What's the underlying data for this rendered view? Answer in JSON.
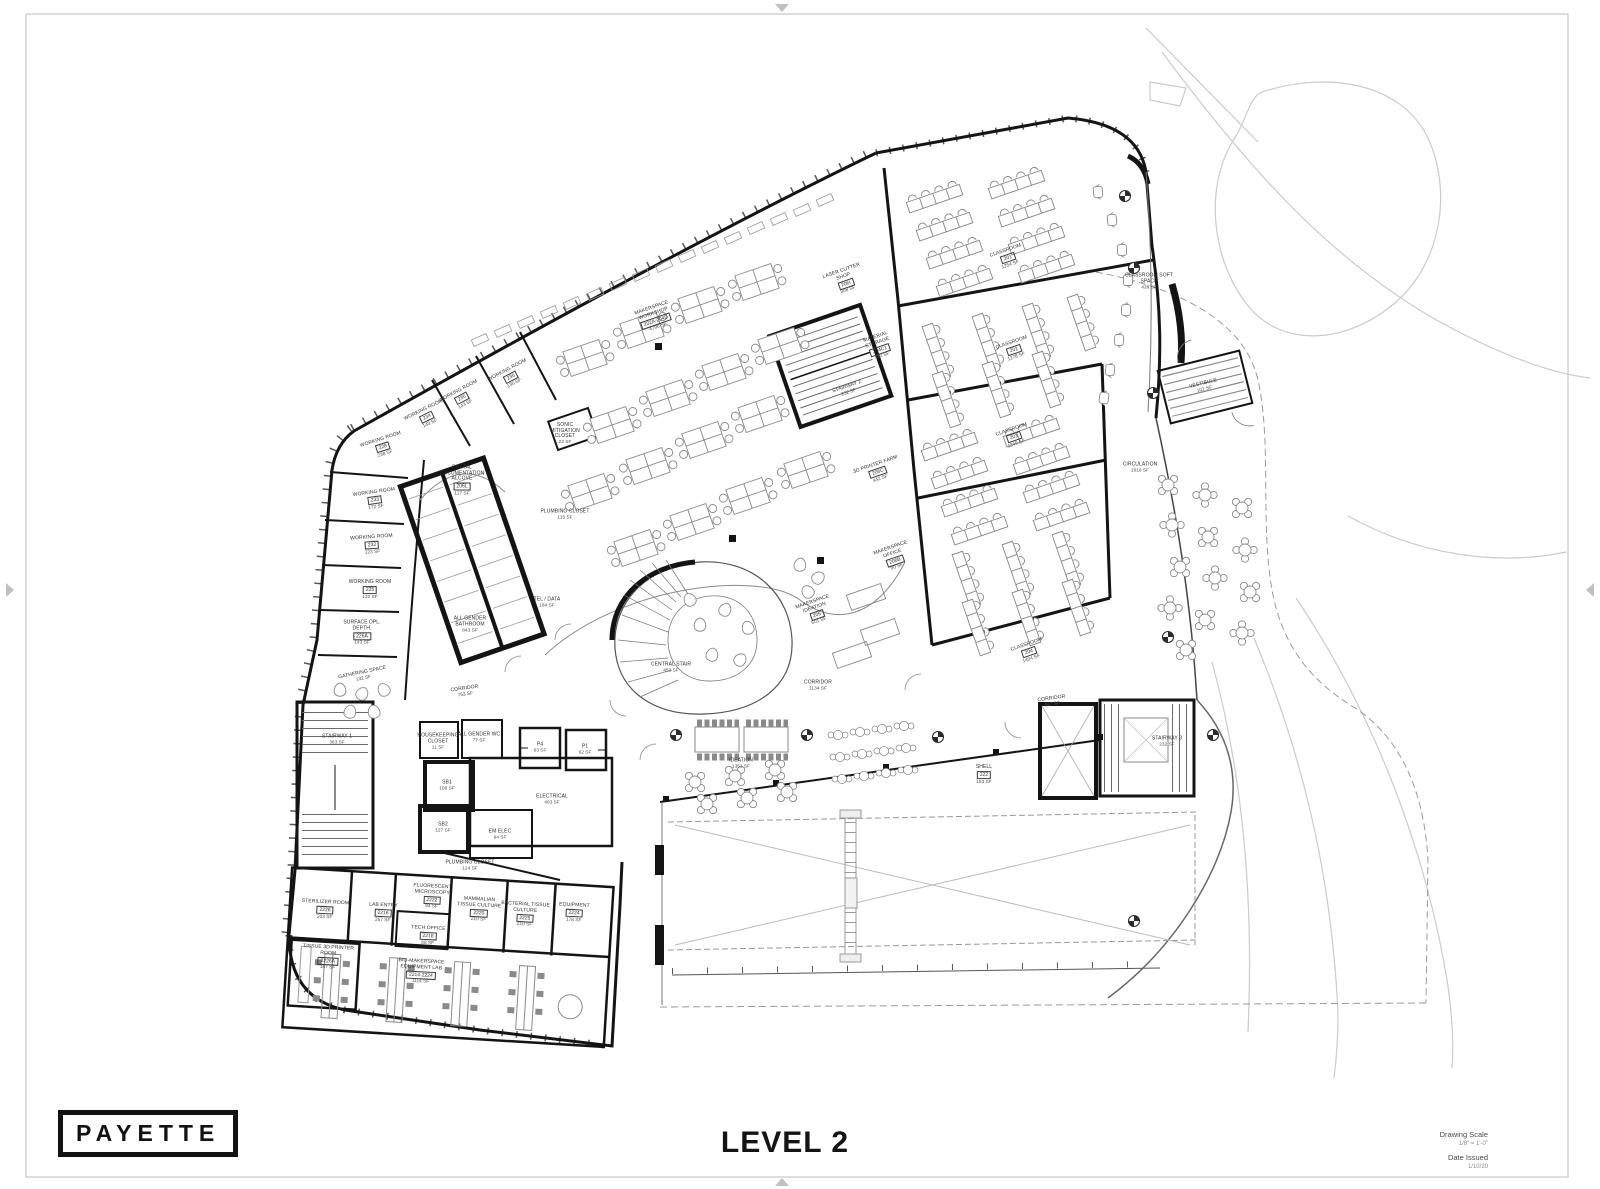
{
  "sheet": {
    "logo": "PAYETTE",
    "title": "LEVEL 2",
    "title_block": {
      "scale_label": "Drawing Scale",
      "scale_value": "1/8\" = 1'-0\"",
      "date_label": "Date Issued",
      "date_value": "1/10/20"
    },
    "line_color": "#141414",
    "site_line_color": "#cbcbcb"
  },
  "plan": {
    "rooms": [
      {
        "name": "MAKERSPACE\nWORKSHOP",
        "num": "202A-204D",
        "sf": "4796 SF",
        "x": 655,
        "y": 318,
        "rot": -19
      },
      {
        "name": "LASER CUTTER\nSHOP",
        "num": "206I",
        "sf": "308 SF",
        "x": 845,
        "y": 281,
        "rot": -19
      },
      {
        "name": "MATERIAL\nSTORAGE",
        "num": "204C1",
        "sf": "432 SF",
        "x": 879,
        "y": 347,
        "rot": -19
      },
      {
        "name": "STAIRWAY 2",
        "num": "",
        "sf": "232 SF",
        "x": 848,
        "y": 390,
        "rot": -19
      },
      {
        "name": "CLASSROOM",
        "num": "201",
        "sf": "1254 SF",
        "x": 1008,
        "y": 258,
        "rot": -19
      },
      {
        "name": "CLASSROOM SOFT\nSPACE",
        "num": "",
        "sf": "438 SF",
        "x": 1149,
        "y": 282,
        "rot": 0
      },
      {
        "name": "CLASSROOM",
        "num": "202",
        "sf": "1278 SF",
        "x": 1014,
        "y": 350,
        "rot": -19
      },
      {
        "name": "CLASSROOM",
        "num": "203",
        "sf": "1349 SF",
        "x": 1014,
        "y": 437,
        "rot": -19
      },
      {
        "name": "CLASSROOM",
        "num": "204",
        "sf": "1404 SF",
        "x": 1029,
        "y": 652,
        "rot": -19
      },
      {
        "name": "CIRCULATION",
        "num": "",
        "sf": "1616 SF",
        "x": 1140,
        "y": 468,
        "rot": 0
      },
      {
        "name": "3D PRINTER FARM",
        "num": "206C",
        "sf": "442 SF",
        "x": 878,
        "y": 472,
        "rot": -19
      },
      {
        "name": "MAKERSPACE\nOFFICE",
        "num": "206B",
        "sf": "90 SF",
        "x": 894,
        "y": 558,
        "rot": -19
      },
      {
        "name": "MAKERSPACE\nIDEATION",
        "num": "205",
        "sf": "501 SF",
        "x": 816,
        "y": 612,
        "rot": -19
      },
      {
        "name": "CORRIDOR",
        "num": "",
        "sf": "1134 SF",
        "x": 818,
        "y": 686,
        "rot": 0
      },
      {
        "name": "CENTRAL STAIR",
        "num": "",
        "sf": "452 SF",
        "x": 671,
        "y": 668,
        "rot": 0
      },
      {
        "name": "SONIC\nMITIGATION\nCLOSET",
        "num": "",
        "sf": "23 SF",
        "x": 565,
        "y": 434,
        "rot": 0
      },
      {
        "name": "DIGITAL\nDOCUMENTATION\nALCOVE",
        "num": "206L",
        "sf": "117 SF",
        "x": 462,
        "y": 481,
        "rot": 0
      },
      {
        "name": "PLUMBING CLOSET",
        "num": "",
        "sf": "115 SF",
        "x": 565,
        "y": 515,
        "rot": 0
      },
      {
        "name": "TEL / DATA",
        "num": "",
        "sf": "184 SF",
        "x": 547,
        "y": 603,
        "rot": 0
      },
      {
        "name": "ALL GENDER\nBATHROOM",
        "num": "",
        "sf": "843 SF",
        "x": 470,
        "y": 625,
        "rot": 0
      },
      {
        "name": "WORKING ROOM",
        "num": "236",
        "sf": "135 SF",
        "x": 511,
        "y": 377,
        "rot": -28
      },
      {
        "name": "WORKING ROOM",
        "num": "235",
        "sf": "143 SF",
        "x": 462,
        "y": 398,
        "rot": -28
      },
      {
        "name": "WORKING ROOM",
        "num": "234",
        "sf": "143 SF",
        "x": 427,
        "y": 417,
        "rot": -26
      },
      {
        "name": "WORKING ROOM",
        "num": "228",
        "sf": "238 SF",
        "x": 383,
        "y": 447,
        "rot": -18
      },
      {
        "name": "WORKING ROOM",
        "num": "233",
        "sf": "172 SF",
        "x": 375,
        "y": 500,
        "rot": -8
      },
      {
        "name": "WORKING ROOM",
        "num": "232",
        "sf": "123 SF",
        "x": 372,
        "y": 545,
        "rot": -4
      },
      {
        "name": "WORKING ROOM",
        "num": "225",
        "sf": "132 SF",
        "x": 370,
        "y": 590,
        "rot": 0
      },
      {
        "name": "SURFACE DPL.\nDEPTH.",
        "num": "226A",
        "sf": "143 SF",
        "x": 362,
        "y": 633,
        "rot": 0
      },
      {
        "name": "GATHERING SPACE",
        "num": "",
        "sf": "132 SF",
        "x": 363,
        "y": 676,
        "rot": -12
      },
      {
        "name": "CORRIDOR",
        "num": "",
        "sf": "753 SF",
        "x": 465,
        "y": 692,
        "rot": -8
      },
      {
        "name": "STAIRWAY 1",
        "num": "",
        "sf": "363 SF",
        "x": 337,
        "y": 740,
        "rot": 0
      },
      {
        "name": "HOUSEKEEPING\nCLOSET",
        "num": "",
        "sf": "11 SF",
        "x": 438,
        "y": 742,
        "rot": 0
      },
      {
        "name": "ALL GENDER WC",
        "num": "",
        "sf": "77 SF",
        "x": 479,
        "y": 738,
        "rot": 0
      },
      {
        "name": "P4",
        "num": "",
        "sf": "63 SF",
        "x": 540,
        "y": 748,
        "rot": 0
      },
      {
        "name": "P1",
        "num": "",
        "sf": "62 SF",
        "x": 585,
        "y": 750,
        "rot": 0
      },
      {
        "name": "SB1",
        "num": "",
        "sf": "106 SF",
        "x": 447,
        "y": 786,
        "rot": 0
      },
      {
        "name": "SB2",
        "num": "",
        "sf": "127 SF",
        "x": 443,
        "y": 828,
        "rot": 0
      },
      {
        "name": "ELECTRICAL",
        "num": "",
        "sf": "403 SF",
        "x": 552,
        "y": 800,
        "rot": 0
      },
      {
        "name": "EM ELEC",
        "num": "",
        "sf": "94 SF",
        "x": 500,
        "y": 835,
        "rot": 0
      },
      {
        "name": "PLUMBING CLOSET",
        "num": "",
        "sf": "124 SF",
        "x": 470,
        "y": 866,
        "rot": 0
      },
      {
        "name": "STERILIZER ROOM",
        "num": "2226",
        "sf": "203 SF",
        "x": 325,
        "y": 910,
        "rot": 3
      },
      {
        "name": "LAB ENTRY",
        "num": "2216",
        "sf": "267 SF",
        "x": 383,
        "y": 913,
        "rot": 3
      },
      {
        "name": "FLUORESCENT\nMICROSCOPY",
        "num": "2222",
        "sf": "94 SF",
        "x": 432,
        "y": 897,
        "rot": 3
      },
      {
        "name": "TECH OFFICE",
        "num": "2218",
        "sf": "88 SF",
        "x": 428,
        "y": 936,
        "rot": 3
      },
      {
        "name": "MAMMALIAN\nTISSUE CULTURE",
        "num": "2220",
        "sf": "210 SF",
        "x": 479,
        "y": 910,
        "rot": 3
      },
      {
        "name": "BACTERIAL TISSUE\nCULTURE",
        "num": "2225",
        "sf": "210 SF",
        "x": 525,
        "y": 915,
        "rot": 3
      },
      {
        "name": "EQUIPMENT",
        "num": "2224",
        "sf": "178 SF",
        "x": 574,
        "y": 913,
        "rot": 3
      },
      {
        "name": "TISSUE 3D PRINTER\nROOM",
        "num": "2226A",
        "sf": "187 SF",
        "x": 328,
        "y": 958,
        "rot": 3
      },
      {
        "name": "BIO-MAKERSPACE\nEQUIPMENT LAB",
        "num": "2214-2224",
        "sf": "1114 SF",
        "x": 421,
        "y": 972,
        "rot": 3
      },
      {
        "name": "IDEATION",
        "num": "",
        "sf": "1351 SF",
        "x": 741,
        "y": 764,
        "rot": 0
      },
      {
        "name": "CORRIDOR",
        "num": "",
        "sf": "967 SF",
        "x": 1052,
        "y": 702,
        "rot": -8
      },
      {
        "name": "SHELL",
        "num": "222",
        "sf": "153 SF",
        "x": 984,
        "y": 775,
        "rot": 0
      },
      {
        "name": "STAIRWAY 3",
        "num": "",
        "sf": "232 SF",
        "x": 1167,
        "y": 742,
        "rot": 0
      },
      {
        "name": "VESTIBULE",
        "num": "",
        "sf": "102 SF",
        "x": 1204,
        "y": 387,
        "rot": -14
      }
    ]
  }
}
